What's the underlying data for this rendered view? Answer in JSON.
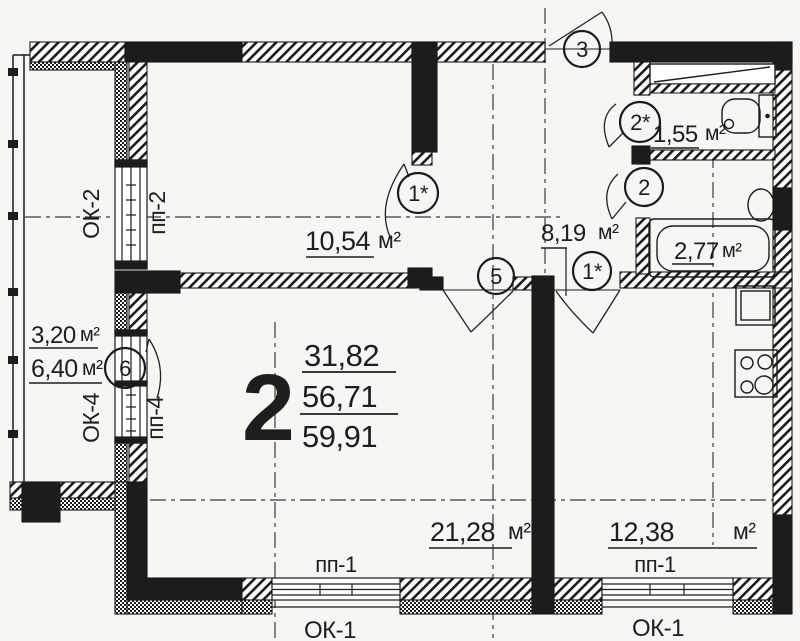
{
  "summary": {
    "room_count": "2",
    "living_area": "31,82",
    "apartment_area": "56,71",
    "total_area": "59,91"
  },
  "areas": {
    "bedroom": {
      "value": "10,54",
      "unit": "м²"
    },
    "hallway": {
      "value": "8,19",
      "unit": "м²"
    },
    "wc": {
      "value": "1,55",
      "unit": "м²"
    },
    "bathroom": {
      "value": "2,77",
      "unit": "м²"
    },
    "balcony_reduced": {
      "value": "3,20",
      "unit": "м²"
    },
    "balcony_full": {
      "value": "6,40",
      "unit": "м²"
    },
    "living_room": {
      "value": "21,28",
      "unit": "м²"
    },
    "kitchen": {
      "value": "12,38",
      "unit": "м²"
    }
  },
  "door_marks": {
    "entrance": "3",
    "wc": "2*",
    "bathroom": "2",
    "bedroom": "1*",
    "living_room": "5",
    "kitchen": "1*",
    "balcony": "6"
  },
  "window_labels": {
    "ok2": "ОК-2",
    "pp2": "пп-2",
    "ok4": "ОК-4",
    "pp4": "пп-4",
    "pp1_left": "пп-1",
    "pp1_right": "пп-1",
    "ok1_left": "ОК-1",
    "ok1_right": "ОК-1"
  }
}
